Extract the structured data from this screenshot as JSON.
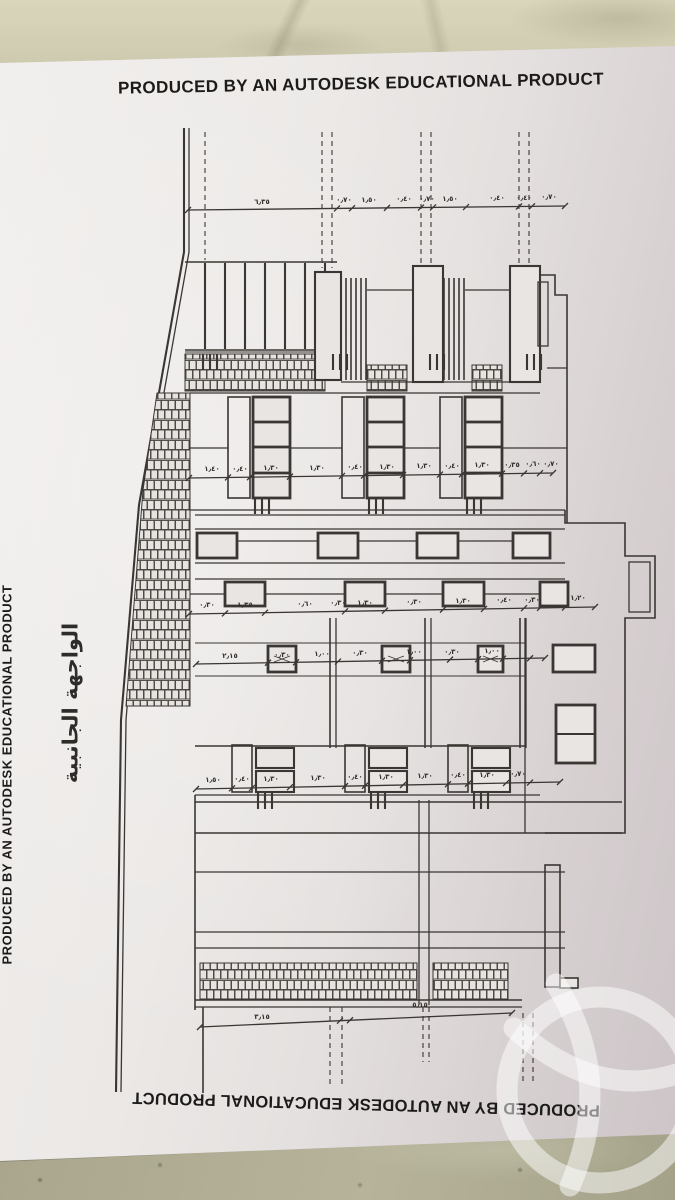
{
  "photo": {
    "surface": "marble countertop",
    "subject": "architectural side-elevation drawing, rotated 90 degrees, on printed sheet"
  },
  "paper": {
    "top_banner": "PRODUCED BY AN AUTODESK EDUCATIONAL PRODUCT",
    "bottom_banner": "PRODUCED BY AN AUTODESK EDUCATIONAL PRODUCT",
    "left_edge_banner": "PRODUCED BY AN AUTODESK EDUCATIONAL PRODUCT",
    "drawing_title_arabic": "الواجهة الجانبية"
  },
  "colors": {
    "paper_light": "#f1efed",
    "paper_shadow": "#ccc4c6",
    "ink": "#3a3633",
    "marble_top": "#d4d0b6",
    "marble_bottom": "#aca98f",
    "watermark": "rgba(255,255,255,0.5)"
  },
  "drawing": {
    "dim_lines": [
      {
        "id": "top",
        "x1": 188,
        "y1": 210,
        "x2": 565,
        "y2": 206,
        "ticks": [
          188,
          337,
          352,
          387,
          421,
          433,
          466,
          519,
          532,
          565
        ]
      },
      {
        "id": "upper_windows",
        "x1": 189,
        "y1": 478,
        "x2": 553,
        "y2": 473,
        "ticks": [
          189,
          228,
          250,
          290,
          342,
          364,
          403,
          440,
          462,
          502,
          524,
          540,
          553
        ]
      },
      {
        "id": "mid",
        "x1": 189,
        "y1": 614,
        "x2": 595,
        "y2": 607,
        "ticks": [
          189,
          225,
          265,
          345,
          385,
          443,
          484,
          524,
          540,
          565,
          595
        ]
      },
      {
        "id": "floor",
        "x1": 196,
        "y1": 664,
        "x2": 545,
        "y2": 658,
        "ticks": [
          196,
          268,
          296,
          338,
          382,
          410,
          450,
          478,
          503,
          530,
          545
        ]
      },
      {
        "id": "lower_windows",
        "x1": 196,
        "y1": 789,
        "x2": 560,
        "y2": 782,
        "ticks": [
          196,
          232,
          252,
          290,
          345,
          365,
          403,
          448,
          468,
          506,
          530,
          560
        ]
      },
      {
        "id": "bottom",
        "x1": 200,
        "y1": 1027,
        "x2": 512,
        "y2": 1013,
        "ticks": [
          200,
          340,
          350,
          512
        ]
      }
    ],
    "dim_labels": [
      {
        "x": 262,
        "y": 204,
        "t": "٦٫٣٥"
      },
      {
        "x": 344,
        "y": 202,
        "t": "٠٫٧٠"
      },
      {
        "x": 369,
        "y": 202,
        "t": "١٫٥٠"
      },
      {
        "x": 404,
        "y": 201,
        "t": "٠٫٤٠"
      },
      {
        "x": 427,
        "y": 201,
        "t": "٠٫٧٠"
      },
      {
        "x": 450,
        "y": 201,
        "t": "١٫٥٠"
      },
      {
        "x": 497,
        "y": 200,
        "t": "٠٫٤٠"
      },
      {
        "x": 524,
        "y": 200,
        "t": "٠٫٤٠"
      },
      {
        "x": 549,
        "y": 199,
        "t": "٠٫٧٠"
      },
      {
        "x": 212,
        "y": 471,
        "t": "١٫٤٠"
      },
      {
        "x": 240,
        "y": 471,
        "t": "٠٫٤٠"
      },
      {
        "x": 271,
        "y": 470,
        "t": "١٫٣٠"
      },
      {
        "x": 317,
        "y": 470,
        "t": "١٫٣٠"
      },
      {
        "x": 355,
        "y": 469,
        "t": "٠٫٤٠"
      },
      {
        "x": 387,
        "y": 469,
        "t": "١٫٣٠"
      },
      {
        "x": 424,
        "y": 468,
        "t": "١٫٣٠"
      },
      {
        "x": 452,
        "y": 468,
        "t": "٠٫٤٠"
      },
      {
        "x": 482,
        "y": 467,
        "t": "١٫٣٠"
      },
      {
        "x": 512,
        "y": 467,
        "t": "٠٫٣٥"
      },
      {
        "x": 533,
        "y": 466,
        "t": "٠٫٦٠"
      },
      {
        "x": 551,
        "y": 466,
        "t": "٠٫٧٠"
      },
      {
        "x": 207,
        "y": 607,
        "t": "٠٫٣٠"
      },
      {
        "x": 245,
        "y": 607,
        "t": "١٫٣٥"
      },
      {
        "x": 305,
        "y": 606,
        "t": "٠٫٦٠"
      },
      {
        "x": 338,
        "y": 605,
        "t": "٠٫٣٠"
      },
      {
        "x": 365,
        "y": 605,
        "t": "١٫٣٠"
      },
      {
        "x": 414,
        "y": 604,
        "t": "٠٫٣٠"
      },
      {
        "x": 463,
        "y": 603,
        "t": "١٫٣٠"
      },
      {
        "x": 504,
        "y": 602,
        "t": "٠٫٤٠"
      },
      {
        "x": 532,
        "y": 602,
        "t": "٠٫٣٠"
      },
      {
        "x": 578,
        "y": 600,
        "t": "١٫٢٠"
      },
      {
        "x": 230,
        "y": 658,
        "t": "٢٫١٥"
      },
      {
        "x": 282,
        "y": 657,
        "t": "٠٫٣٠"
      },
      {
        "x": 322,
        "y": 656,
        "t": "١٫٠٠"
      },
      {
        "x": 360,
        "y": 655,
        "t": "٠٫٣٠"
      },
      {
        "x": 414,
        "y": 654,
        "t": "١٫٠٠"
      },
      {
        "x": 452,
        "y": 654,
        "t": "٠٫٣٠"
      },
      {
        "x": 492,
        "y": 653,
        "t": "١٫٠٠"
      },
      {
        "x": 213,
        "y": 782,
        "t": "١٫٥٠"
      },
      {
        "x": 242,
        "y": 781,
        "t": "٠٫٤٠"
      },
      {
        "x": 271,
        "y": 781,
        "t": "١٫٣٠"
      },
      {
        "x": 318,
        "y": 780,
        "t": "١٫٣٠"
      },
      {
        "x": 355,
        "y": 779,
        "t": "٠٫٤٠"
      },
      {
        "x": 386,
        "y": 779,
        "t": "١٫٣٠"
      },
      {
        "x": 425,
        "y": 778,
        "t": "١٫٣٠"
      },
      {
        "x": 458,
        "y": 777,
        "t": "٠٫٤٠"
      },
      {
        "x": 487,
        "y": 777,
        "t": "١٫٣٠"
      },
      {
        "x": 518,
        "y": 776,
        "t": "٠٫٧٠"
      },
      {
        "x": 262,
        "y": 1019,
        "t": "٣٫١٥"
      },
      {
        "x": 420,
        "y": 1007,
        "t": "٥٫١٥"
      }
    ]
  }
}
